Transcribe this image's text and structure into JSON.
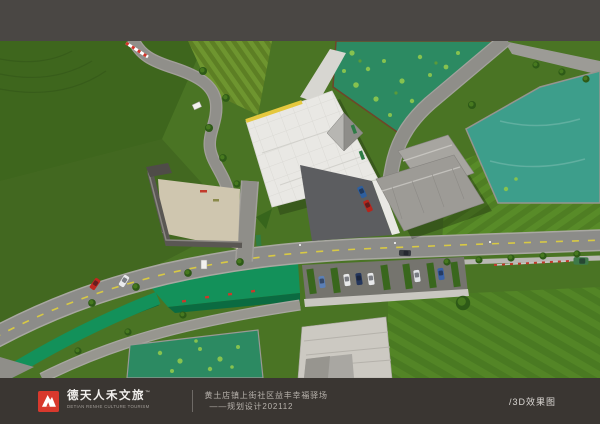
{
  "footer": {
    "logo": {
      "cn": "德天人禾文旅",
      "tm": "™",
      "en": "DETIAN RENHE CULTURE TOURISM"
    },
    "caption_line1": "黄土店镇上街社区益丰幸福驿场",
    "caption_line2": "——规划设计202112",
    "right_label": "/3D效果图"
  },
  "colors": {
    "bar_top": "#4a4744",
    "bar_bottom": "#3a3632",
    "brand_red": "#d8392d",
    "footer_text": "#b7b2ac",
    "footer_bright": "#d9d6d2",
    "grass": "#4a7424",
    "grass_dark": "#3e661d",
    "water_teal": "#3d9e8b",
    "water_algae": "#2c8a62",
    "canal_green": "#13915a",
    "road": "#8c8c89",
    "road_light": "#a9a8a2",
    "dash_yellow": "#d8c944",
    "plaza": "#e9e8e4",
    "roof_gray": "#9d9b96",
    "asphalt": "#5c5d60"
  },
  "scene": {
    "description": "aerial 3D rendering of a village community plan",
    "objects": [
      "hillside-grass",
      "terraced-field",
      "lotus-pond",
      "clear-pond",
      "central-plaza-canopy",
      "glass-pyramid",
      "gray-roof-building",
      "paved-courtyard",
      "main-road",
      "branch-road",
      "greenway-canal",
      "parking-row",
      "farmhouse-roof",
      "roadside-trees",
      "vehicles"
    ]
  }
}
